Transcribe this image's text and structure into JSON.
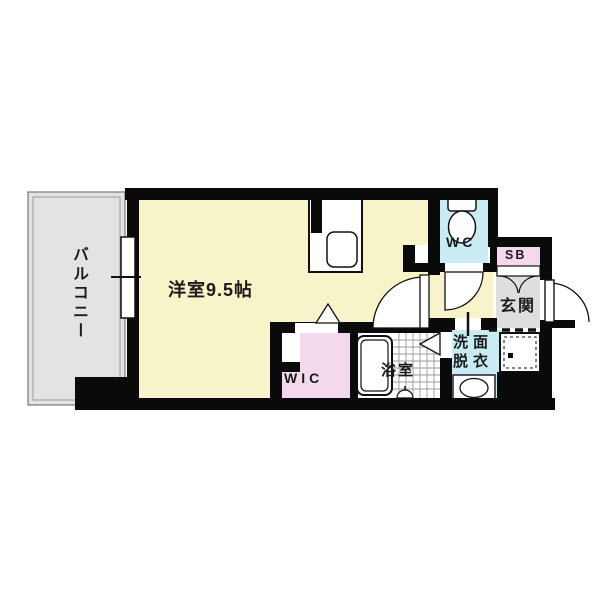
{
  "figure": {
    "type": "apartment-floor-plan",
    "main_room_size_label": "9.5帖"
  },
  "labels": {
    "balcony": "バルコニー",
    "main_room": "洋室9.5帖",
    "wc": "WC",
    "shoe_box": "SB",
    "entrance": "玄関",
    "walk_in_closet": "WIC",
    "bathroom": "浴室",
    "washroom_line1": "洗面",
    "washroom_line2": "脱衣"
  },
  "palette": {
    "wall_black": "#0a0a0a",
    "room_yellow": "#f8f4c9",
    "balcony_gray": "#e3e3e3",
    "entrance_gray": "#dedede",
    "water_blue": "#c9ecf2",
    "closet_pink": "#f3d9eb",
    "fixture_white": "#ffffff",
    "tile_line": "#9a9a9a",
    "outline": "#111111"
  }
}
